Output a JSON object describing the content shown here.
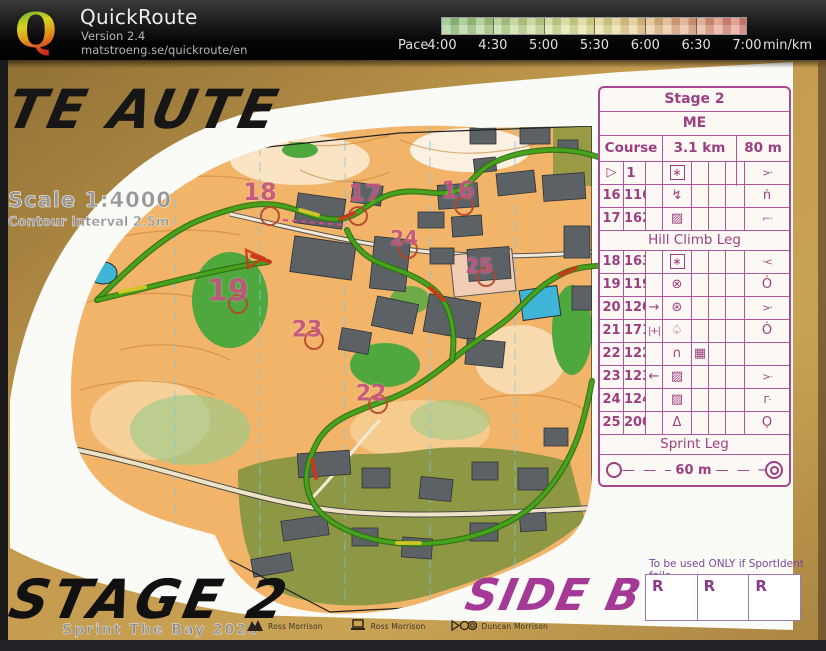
{
  "header": {
    "app_name": "QuickRoute",
    "version": "Version 2.4",
    "url": "matstroeng.se/quickroute/en",
    "logo_letter": "Q",
    "pace_label": "Pace",
    "pace_unit": "min/km",
    "pace_ticks": [
      "4:00",
      "4:30",
      "5:00",
      "5:30",
      "6:00",
      "6:30",
      "7:00"
    ],
    "pace_gradient": [
      "#8cc17c",
      "#aacd82",
      "#c9d98a",
      "#e4de8e",
      "#e4c384",
      "#e29d7b",
      "#df7f78"
    ]
  },
  "map": {
    "title": "TE AUTE",
    "scale": "Scale 1:4000",
    "contour": "Contour Interval 2.5m",
    "stage": "STAGE 2",
    "event": "Sprint The Bay 2020",
    "side": "SIDE B",
    "control_labels": [
      {
        "n": "16",
        "x": 458,
        "y": 190,
        "s": 24
      },
      {
        "n": "17",
        "x": 365,
        "y": 193,
        "s": 24
      },
      {
        "n": "18",
        "x": 260,
        "y": 192,
        "s": 24
      },
      {
        "n": "19",
        "x": 228,
        "y": 291,
        "s": 30
      },
      {
        "n": "22",
        "x": 371,
        "y": 394,
        "s": 22
      },
      {
        "n": "23",
        "x": 307,
        "y": 330,
        "s": 22
      },
      {
        "n": "24",
        "x": 404,
        "y": 238,
        "s": 20
      },
      {
        "n": "25",
        "x": 479,
        "y": 266,
        "s": 20
      }
    ],
    "sponsors": [
      {
        "icon": "mountain-icon",
        "name": "Ross Morrison"
      },
      {
        "icon": "laptop-icon",
        "name": "Ross Morrison"
      },
      {
        "icon": "video-icon",
        "name": "Duncan Morrison"
      }
    ]
  },
  "control_sheet": {
    "title": "Stage 2",
    "class_name": "ME",
    "course": "Course 1",
    "length": "3.1 km",
    "climb": "80 m",
    "glyphs": {
      "start": "▷",
      "flowerbox": "∗",
      "stairs": "↯",
      "building": "▨",
      "cross-circle": "⊗",
      "thicket": "⊛",
      "spring": "♤",
      "knoll": "∩",
      "paved": "▦",
      "statue": "Δ",
      "arrow-right": "→",
      "arrow-left": "←",
      "between": "|+|",
      "angle-right-dot": ">·",
      "n-dot": "ṅ",
      "corner-left-dot": "⌐·",
      "dot-angle-left": "·<",
      "circle-dot-top": "Ȯ",
      "corner-dot": "Γ·",
      "circle-dot-bottom": "Ọ"
    },
    "rows": [
      {
        "cells": [
          "start",
          "",
          "",
          "flowerbox",
          "",
          "",
          "",
          "angle-right-dot"
        ],
        "start": true
      },
      {
        "cells": [
          "16",
          "116",
          "",
          "stairs",
          "",
          "",
          "",
          "n-dot"
        ]
      },
      {
        "cells": [
          "17",
          "162",
          "",
          "building",
          "",
          "",
          "",
          "corner-left-dot"
        ]
      },
      {
        "banner": "Hill Climb Leg"
      },
      {
        "cells": [
          "18",
          "163",
          "",
          "flowerbox",
          "",
          "",
          "",
          "dot-angle-left"
        ]
      },
      {
        "cells": [
          "19",
          "119",
          "",
          "cross-circle",
          "",
          "",
          "",
          "circle-dot-top"
        ]
      },
      {
        "cells": [
          "20",
          "120",
          "arrow-right",
          "thicket",
          "",
          "",
          "",
          "angle-right-dot"
        ]
      },
      {
        "cells": [
          "21",
          "171",
          "between",
          "spring",
          "",
          "",
          "",
          "circle-dot-top"
        ]
      },
      {
        "cells": [
          "22",
          "122",
          "",
          "knoll",
          "paved",
          "",
          "",
          ""
        ]
      },
      {
        "cells": [
          "23",
          "123",
          "arrow-left",
          "building",
          "",
          "",
          "",
          "angle-right-dot"
        ]
      },
      {
        "cells": [
          "24",
          "124",
          "",
          "building",
          "",
          "",
          "",
          "corner-dot"
        ]
      },
      {
        "cells": [
          "25",
          "200",
          "",
          "statue",
          "",
          "",
          "",
          "circle-dot-bottom"
        ]
      },
      {
        "banner": "Sprint Leg"
      },
      {
        "finish": true,
        "distance": "60 m"
      }
    ],
    "si_note": "To be used ONLY if SportIdent fails",
    "si_cells": [
      "R",
      "R",
      "R"
    ]
  }
}
